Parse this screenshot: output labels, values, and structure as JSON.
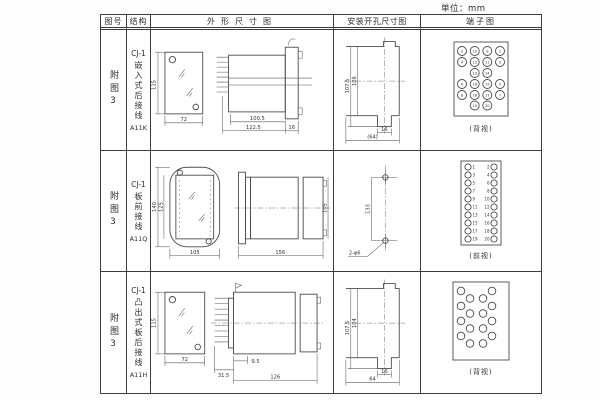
{
  "page": {
    "unit_label": "单位：mm"
  },
  "headers": {
    "fig_no": "图号",
    "structure": "结构",
    "outline": "外形尺寸图",
    "install": "安装开孔尺寸图",
    "terminal": "端子图"
  },
  "rows": [
    {
      "fig_no": "附图3",
      "structure": {
        "model": "CJ-1",
        "type": "嵌入式后接线",
        "code": "A11K"
      },
      "outline": {
        "front_height": "115",
        "front_width": "72",
        "body_width": "100.5",
        "total_width": "122.5",
        "flange_width": "16"
      },
      "install": {
        "outer_height": "107.5",
        "inner_height": "106",
        "slot_width": "16",
        "overall_width": "(64)"
      },
      "terminal": {
        "view_label": "(背视)",
        "numbers": [
          "2",
          "10",
          "9",
          "1",
          "4",
          "12",
          "11",
          "3",
          "13",
          "14",
          "6",
          "16",
          "15",
          "5",
          "8",
          "18",
          "17",
          "7",
          "19",
          "20"
        ]
      }
    },
    {
      "fig_no": "附图3",
      "structure": {
        "model": "CJ-1",
        "type": "板前接线",
        "code": "A11Q"
      },
      "outline": {
        "height_outer": "140",
        "height_inner": "125",
        "width": "105",
        "side_length": "156",
        "side_height": "105"
      },
      "install": {
        "hole_spacing": "133",
        "hole_label": "2-φ6"
      },
      "terminal": {
        "view_label": "(前视)",
        "left_numbers": [
          "1",
          "3",
          "5",
          "7",
          "9",
          "11",
          "13",
          "15",
          "17",
          "19"
        ],
        "right_numbers": [
          "2",
          "4",
          "6",
          "8",
          "10",
          "12",
          "14",
          "16",
          "18",
          "20"
        ]
      }
    },
    {
      "fig_no": "附图3",
      "structure": {
        "model": "CJ-1",
        "type": "凸出式板后接线",
        "code": "A11H"
      },
      "outline": {
        "front_height": "115",
        "front_width": "72",
        "pin_depth": "31.5",
        "offset": "9.5",
        "total_length": "126"
      },
      "install": {
        "outer_height": "107.5",
        "inner_height": "104",
        "slot_width": "16",
        "overall_width": "64"
      },
      "terminal": {
        "view_label": "(背视)"
      }
    }
  ]
}
